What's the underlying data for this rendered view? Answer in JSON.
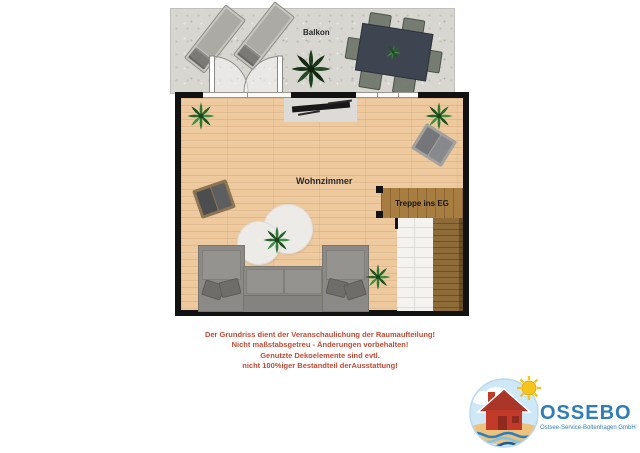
{
  "plan": {
    "balcony_label": "Balkon",
    "living_room_label": "Wohnzimmer",
    "stairs_label": "Treppe ins EG"
  },
  "disclaimer": {
    "lines": [
      "Der Grundriss dient der Veranschaulichung der Raumaufteilung!",
      "Nicht maßstabsgetreu - Änderungen vorbehalten!",
      "Genutzte Dekoelemente sind evtl.",
      "nicht 100%iger Bestandteil derAusstattung!"
    ]
  },
  "logo": {
    "company": "OSSEBO",
    "tagline": "Ostsee-Service-Boltenhagen GmbH"
  },
  "colors": {
    "disclaimer_red": "#c14b36",
    "logo_blue": "#2e7db8",
    "wall_black": "#121212",
    "wood_floor": "#edc99d",
    "balcony_gray": "#d7d6d1",
    "stair_wood": "#8d6c3a",
    "landing_wood": "#a87d41",
    "sofa_gray": "#8c8a87",
    "table_dark": "#3e4450",
    "house_red": "#c23b2a",
    "sun_yellow": "#f6c51d",
    "sea_blue": "#2b7fc1"
  }
}
